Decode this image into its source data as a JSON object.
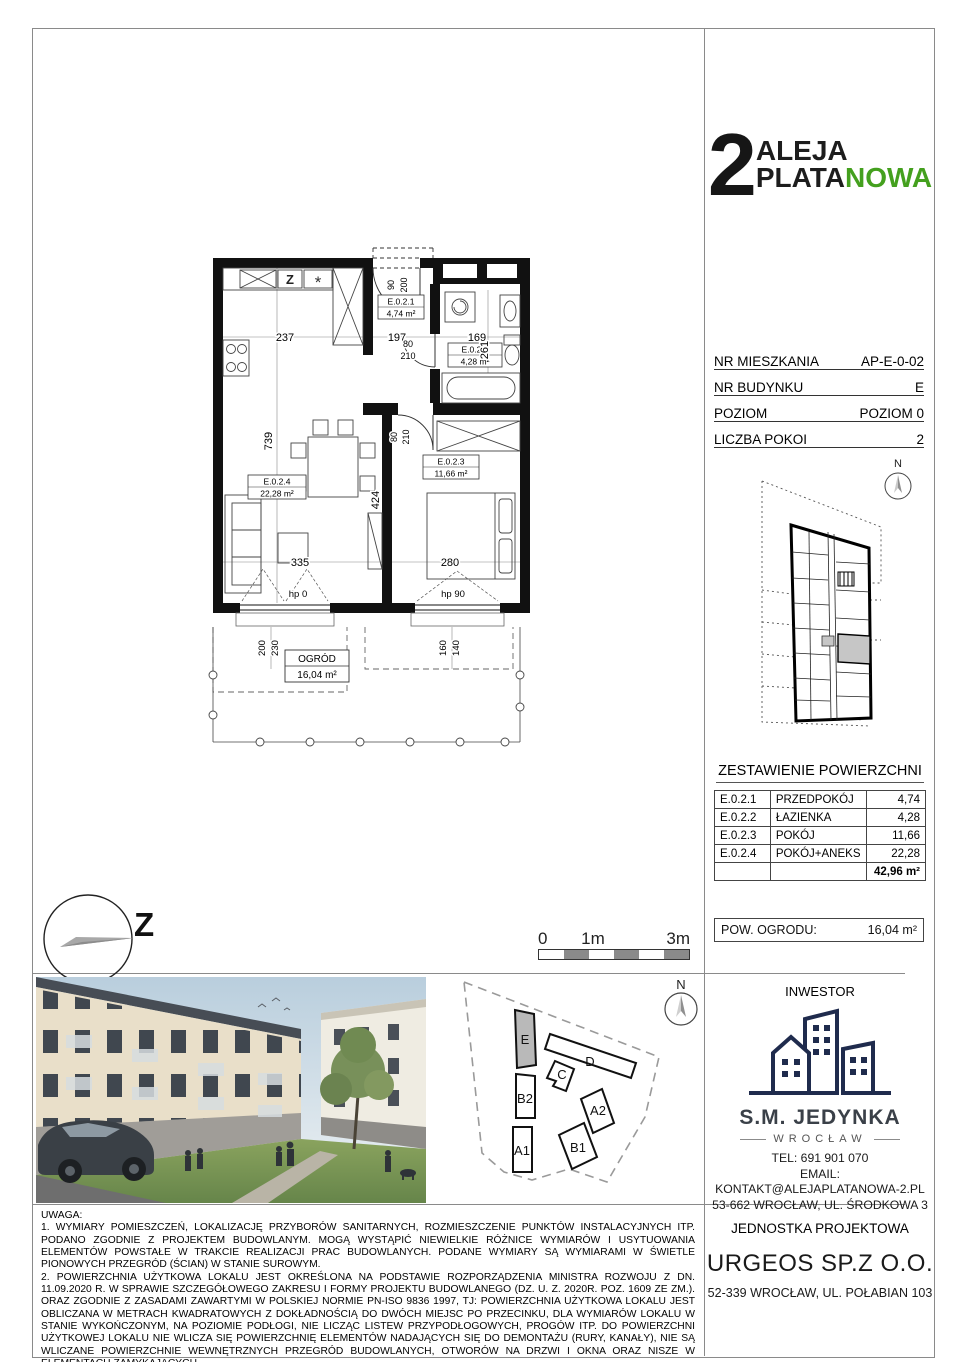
{
  "logo": {
    "number": "2",
    "word1": "ALEJA",
    "word2a": "PLATA",
    "word2b": "NOWA",
    "accent_color": "#44a01e"
  },
  "info": {
    "rows": [
      {
        "label": "NR MIESZKANIA",
        "value": "AP-E-0-02"
      },
      {
        "label": "NR BUDYNKU",
        "value": "E"
      },
      {
        "label": "POZIOM",
        "value": "POZIOM 0"
      },
      {
        "label": "LICZBA POKOI",
        "value": "2"
      }
    ]
  },
  "areas": {
    "title": "ZESTAWIENIE POWIERZCHNI",
    "rows": [
      {
        "code": "E.0.2.1",
        "name": "PRZEDPOKÓJ",
        "value": "4,74"
      },
      {
        "code": "E.0.2.2",
        "name": "ŁAZIENKA",
        "value": "4,28"
      },
      {
        "code": "E.0.2.3",
        "name": "POKÓJ",
        "value": "11,66"
      },
      {
        "code": "E.0.2.4",
        "name": "POKÓJ+ANEKS",
        "value": "22,28"
      }
    ],
    "total": "42,96 m²"
  },
  "garden_box": {
    "label": "POW. OGRODU:",
    "value": "16,04 m²"
  },
  "plan": {
    "rooms": [
      {
        "id": "E.0.2.1",
        "area": "4,74 m²"
      },
      {
        "id": "E.0.2.2",
        "area": "4,28 m²"
      },
      {
        "id": "E.0.2.3",
        "area": "11,66 m²"
      },
      {
        "id": "E.0.2.4",
        "area": "22,28 m²"
      }
    ],
    "garden_label": "OGRÓD",
    "garden_area": "16,04 m²",
    "dims": {
      "kitchen_w": "237",
      "hall_w": "197",
      "bath_w": "169",
      "left_h": "739",
      "bath_h": "261",
      "bed_wall": "424",
      "living_w": "335",
      "bed_w": "280",
      "entry_w": "90",
      "entry_h": "200",
      "door_w": "80",
      "door_h": "210",
      "hp_left": "hp 0",
      "hp_right": "hp 90",
      "win_left_a": "200",
      "win_left_b": "230",
      "win_right_a": "160",
      "win_right_b": "140"
    }
  },
  "scalebar": {
    "t0": "0",
    "t1": "1m",
    "t2": "3m"
  },
  "compass": {
    "west": "Z",
    "north": "N"
  },
  "sitemap": {
    "e": "E",
    "d": "D",
    "c": "C",
    "b2": "B2",
    "a2": "A2",
    "a1": "A1",
    "b1": "B1"
  },
  "investor": {
    "title": "INWESTOR",
    "name": "S.M. JEDYNKA",
    "city": "WROCŁAW",
    "tel": "TEL: 691 901 070",
    "email_label": "EMAIL:",
    "email": "KONTAKT@ALEJAPLATANOWA-2.PL",
    "address": "53-662 WROCŁAW, UL. ŚRODKOWA 3"
  },
  "designer": {
    "title": "JEDNOSTKA PROJEKTOWA",
    "name": "URGEOS SP.Z O.O.",
    "address": "52-339 WROCŁAW, UL. POŁABIAN 103"
  },
  "notes": {
    "title": "UWAGA:",
    "items": [
      "1. WYMIARY POMIESZCZEŃ, LOKALIZACJĘ PRZYBORÓW SANITARNYCH, ROZMIESZCZENIE PUNKTÓW INSTALACYJNYCH ITP. PODANO ZGODNIE Z PROJEKTEM BUDOWLANYM. MOGĄ WYSTĄPIĆ NIEWIELKIE RÓŻNICE WYMIARÓW I USYTUOWANIA ELEMENTÓW POWSTAŁE W TRAKCIE REALIZACJI PRAC BUDOWLANYCH. PODANE WYMIARY SĄ WYMIARAMI W ŚWIETLE PIONOWYCH PRZEGRÓD (ŚCIAN) W STANIE SUROWYM.",
      "2. POWIERZCHNIA UŻYTKOWA LOKALU JEST OKREŚLONA NA PODSTAWIE ROZPORZĄDZENIA MINISTRA ROZWOJU Z DN. 11.09.2020 R. W SPRAWIE SZCZEGÓŁOWEGO ZAKRESU I FORMY PROJEKTU BUDOWLANEGO (DZ. U. Z. 2020R. POZ. 1609 ZE ZM.). ORAZ ZGODNIE Z ZASADAMI ZAWARTYMI W POLSKIEJ NORMIE PN-ISO 9836 1997, TJ: POWIERZCHNIA UŻYTKOWA LOKALU JEST OBLICZANA W METRACH KWADRATOWYCH Z DOKŁADNOŚCIĄ DO DWÓCH MIEJSC PO PRZECINKU, DLA WYMIARÓW LOKALU W STANIE WYKOŃCZONYM, NA POZIOMIE PODŁOGI, NIE LICZĄC LISTEW PRZYPODŁOGOWYCH, PROGÓW ITP. DO POWIERZCHNI UŻYTKOWEJ LOKALU NIE WLICZA SIĘ POWIERZCHNIĘ ELEMENTÓW NADAJĄCYCH SIĘ DO DEMONTAŻU (RURY, KANAŁY), NIE SĄ WLICZANE POWIERZCHNIE WEWNĘTRZNYCH PRZEGRÓD BUDOWLANYCH, OTWORÓW NA DRZWI I OKNA ORAZ NISZE W ELEMENTACH ZAMYKAJĄCYCH.",
      "3. PRZEDSTAWIONA NA RZUCIE ARANŻACJA MA CHARAKTER PRZYKŁADOWY I UMEBLOWANIE NIE STANOWI WYPOSAŻENIA LOKALU."
    ]
  }
}
